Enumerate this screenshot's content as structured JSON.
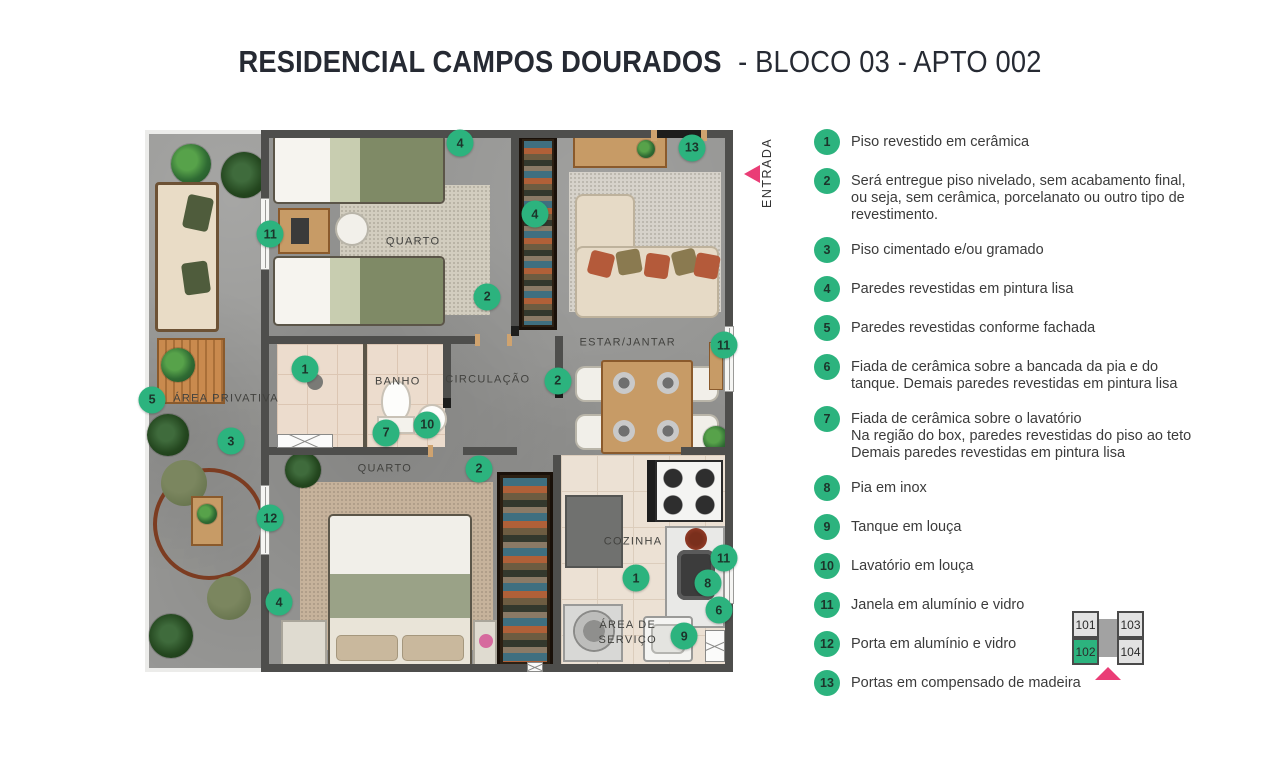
{
  "title": {
    "bold": "RESIDENCIAL CAMPOS DOURADOS",
    "regular": "- BLOCO 03 - APTO 002"
  },
  "entry": {
    "label": "ENTRADA"
  },
  "colors": {
    "accent_green": "#2cb37e",
    "accent_pink": "#ea3d76",
    "wall_gray": "#4e4e4c"
  },
  "plan": {
    "rooms": [
      {
        "id": "quarto-1",
        "label": "QUARTO",
        "x": 45.6,
        "y": 20.7
      },
      {
        "id": "banho",
        "label": "BANHO",
        "x": 43.0,
        "y": 46.5
      },
      {
        "id": "circulacao",
        "label": "CIRCULAÇÃO",
        "x": 58.3,
        "y": 46.1
      },
      {
        "id": "estar-jantar",
        "label": "ESTAR/JANTAR",
        "x": 82.1,
        "y": 39.3
      },
      {
        "id": "area-privativa",
        "label": "ÁREA PRIVATIVA",
        "x": 4.8,
        "y": 49.6
      },
      {
        "id": "quarto-2",
        "label": "QUARTO",
        "x": 40.8,
        "y": 62.5
      },
      {
        "id": "cozinha",
        "label": "COZINHA",
        "x": 83.0,
        "y": 76.0
      },
      {
        "id": "area-servico",
        "label": "ÁREA DE\nSERVIÇO",
        "x": 82.1,
        "y": 92.8
      }
    ],
    "markers": [
      {
        "n": "4",
        "x": 53.6,
        "y": 2.4
      },
      {
        "n": "13",
        "x": 93.0,
        "y": 3.3
      },
      {
        "n": "11",
        "x": 21.3,
        "y": 19.2
      },
      {
        "n": "4",
        "x": 66.3,
        "y": 15.5
      },
      {
        "n": "2",
        "x": 58.2,
        "y": 30.8
      },
      {
        "n": "11",
        "x": 98.4,
        "y": 39.7
      },
      {
        "n": "1",
        "x": 27.2,
        "y": 44.1
      },
      {
        "n": "2",
        "x": 70.2,
        "y": 46.3
      },
      {
        "n": "5",
        "x": 1.2,
        "y": 49.8
      },
      {
        "n": "7",
        "x": 41.0,
        "y": 55.9
      },
      {
        "n": "10",
        "x": 48.0,
        "y": 54.4
      },
      {
        "n": "3",
        "x": 14.6,
        "y": 57.4
      },
      {
        "n": "2",
        "x": 56.8,
        "y": 62.5
      },
      {
        "n": "12",
        "x": 21.3,
        "y": 71.6
      },
      {
        "n": "4",
        "x": 22.8,
        "y": 87.1
      },
      {
        "n": "1",
        "x": 83.5,
        "y": 82.7
      },
      {
        "n": "11",
        "x": 98.4,
        "y": 79.0
      },
      {
        "n": "8",
        "x": 95.7,
        "y": 83.6
      },
      {
        "n": "6",
        "x": 97.6,
        "y": 88.6
      },
      {
        "n": "9",
        "x": 91.7,
        "y": 93.4
      }
    ]
  },
  "legend": {
    "items": [
      {
        "n": "1",
        "text": "Piso revestido em cerâmica"
      },
      {
        "n": "2",
        "text": "Será entregue piso nivelado, sem acabamento final,\nou seja, sem cerâmica, porcelanato ou outro tipo de\nrevestimento."
      },
      {
        "n": "3",
        "text": "Piso cimentado e/ou gramado"
      },
      {
        "n": "4",
        "text": "Paredes revestidas em pintura lisa"
      },
      {
        "n": "5",
        "text": "Paredes revestidas conforme fachada"
      },
      {
        "n": "6",
        "text": "Fiada de cerâmica sobre a bancada da pia e do\ntanque. Demais paredes revestidas em pintura lisa"
      },
      {
        "n": "7",
        "text": "Fiada de cerâmica sobre o lavatório\nNa região do box, paredes revestidas do piso ao teto\nDemais paredes revestidas em pintura lisa"
      },
      {
        "n": "8",
        "text": "Pia em inox"
      },
      {
        "n": "9",
        "text": "Tanque em louça"
      },
      {
        "n": "10",
        "text": "Lavatório em louça"
      },
      {
        "n": "11",
        "text": "Janela em alumínio e vidro"
      },
      {
        "n": "12",
        "text": "Porta em alumínio e vidro"
      },
      {
        "n": "13",
        "text": "Portas em compensado de madeira"
      }
    ]
  },
  "unit_map": {
    "units": [
      {
        "id": "101",
        "highlight": false
      },
      {
        "id": "102",
        "highlight": true
      },
      {
        "id": "103",
        "highlight": false
      },
      {
        "id": "104",
        "highlight": false
      }
    ]
  }
}
